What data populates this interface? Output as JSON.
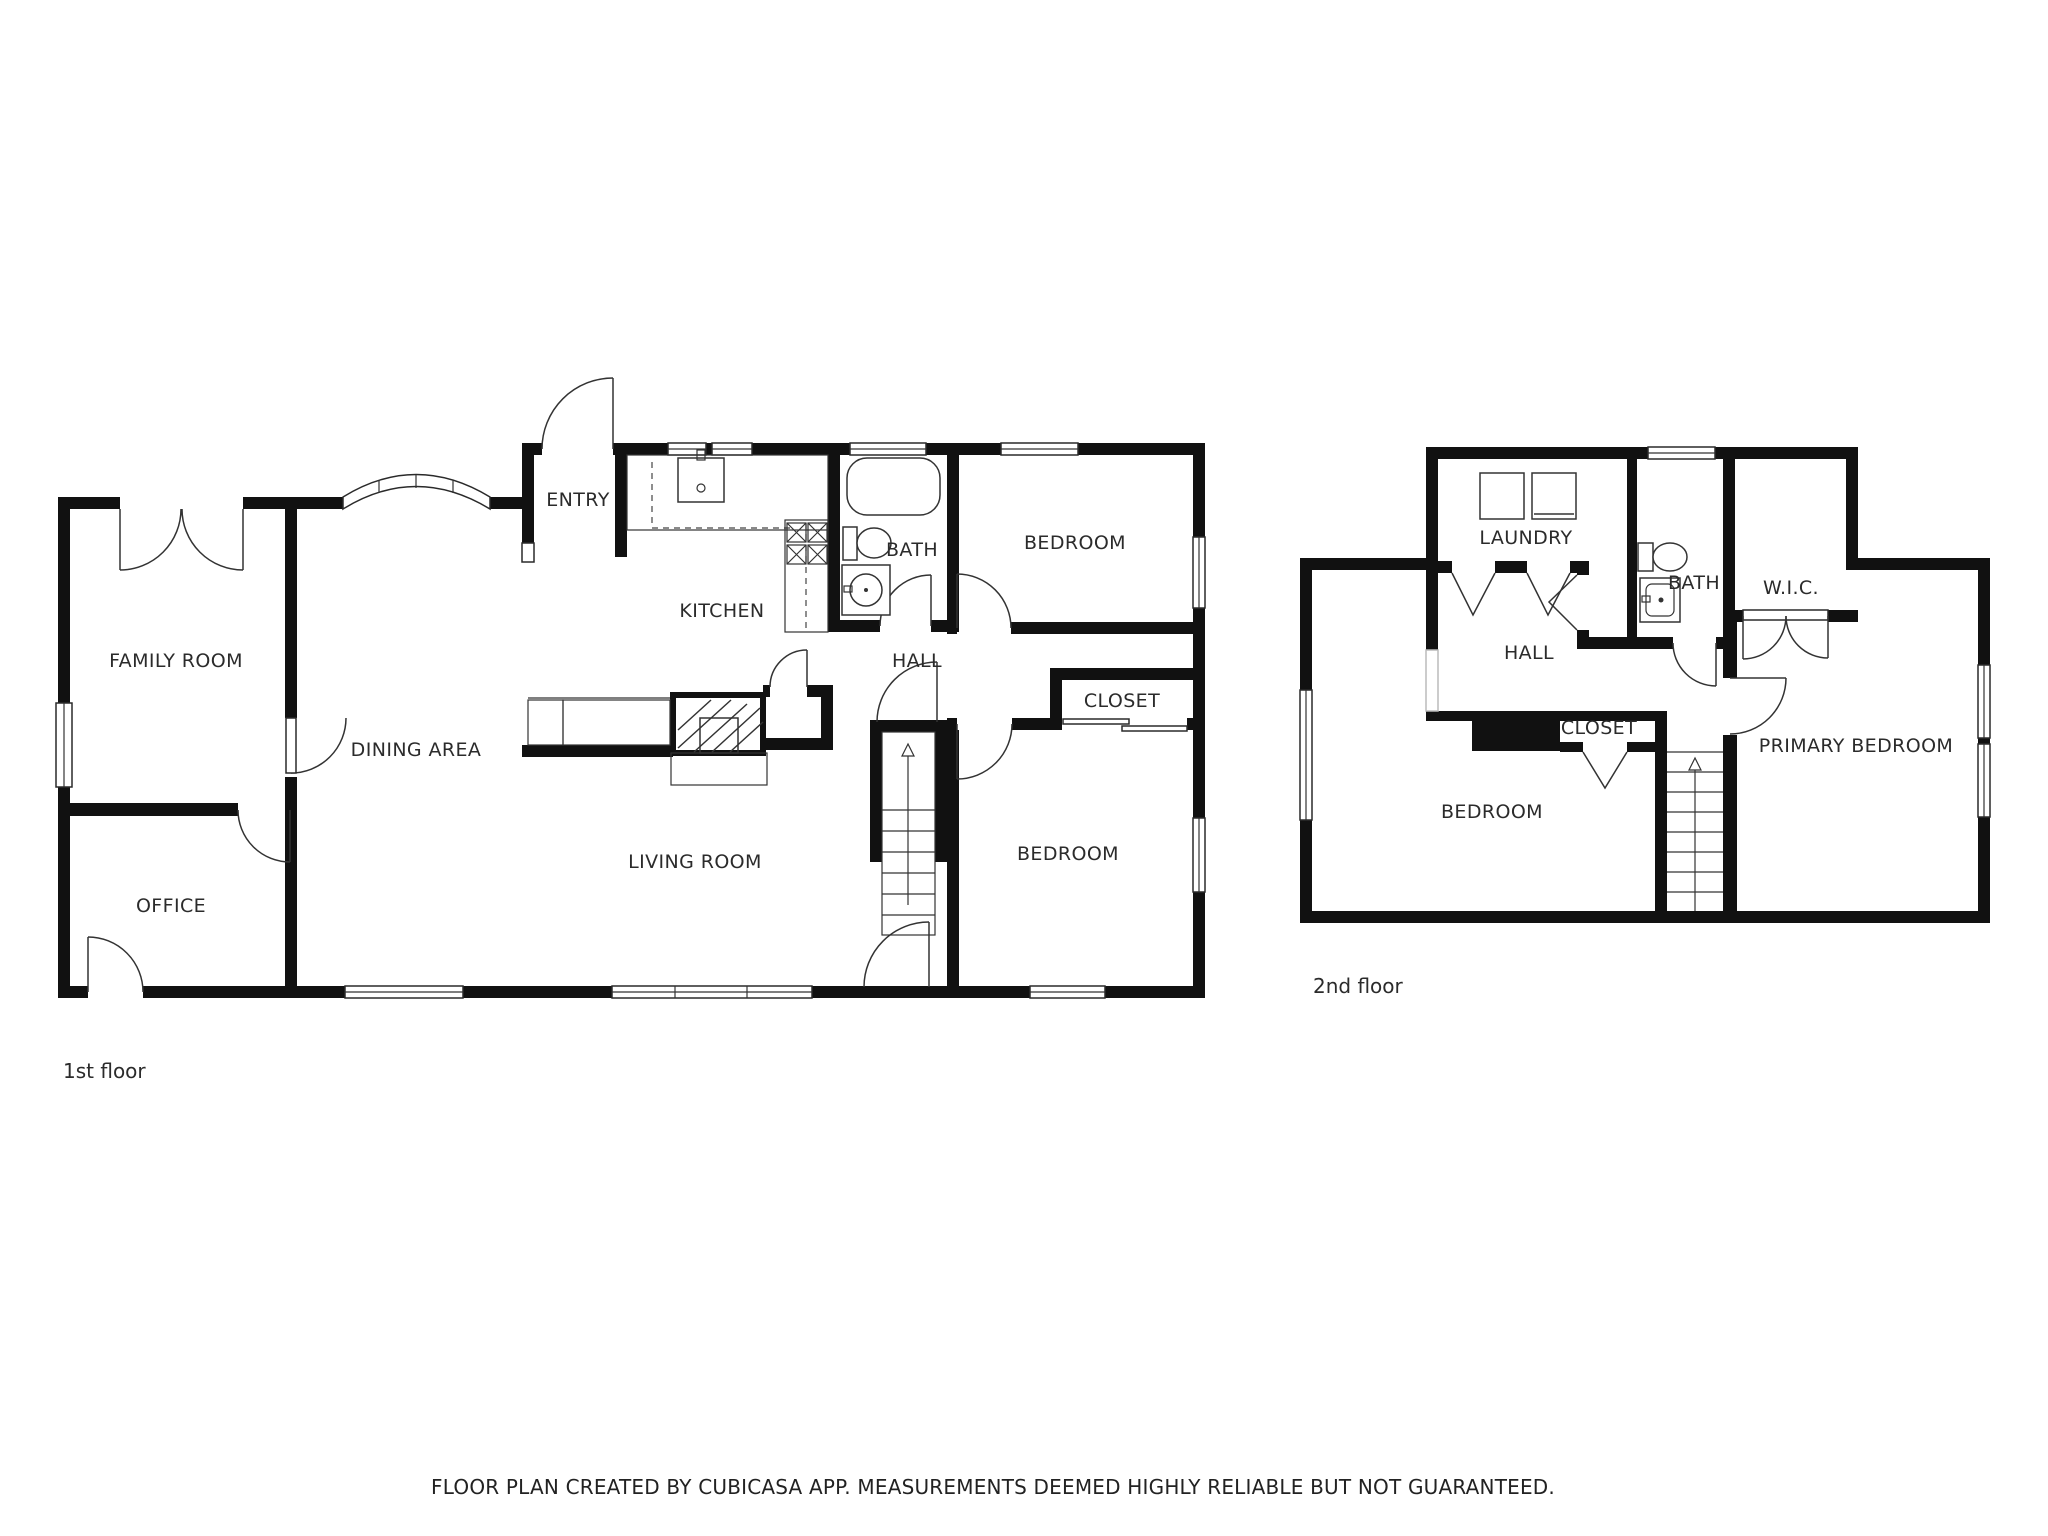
{
  "floors": [
    {
      "caption": "1st floor",
      "rooms": [
        {
          "label": "ENTRY"
        },
        {
          "label": "KITCHEN"
        },
        {
          "label": "BATH"
        },
        {
          "label": "BEDROOM"
        },
        {
          "label": "HALL"
        },
        {
          "label": "CLOSET"
        },
        {
          "label": "FAMILY ROOM"
        },
        {
          "label": "DINING AREA"
        },
        {
          "label": "LIVING ROOM"
        },
        {
          "label": "OFFICE"
        },
        {
          "label": "BEDROOM"
        }
      ],
      "fixtures": [
        "entry-door",
        "french-doors",
        "bay-window",
        "kitchen-sink",
        "stove-burners",
        "bathtub",
        "toilet",
        "bathroom-sink",
        "fireplace",
        "staircase-up",
        "sliding-closet-door"
      ]
    },
    {
      "caption": "2nd floor",
      "rooms": [
        {
          "label": "LAUNDRY"
        },
        {
          "label": "BATH"
        },
        {
          "label": "W.I.C."
        },
        {
          "label": "HALL"
        },
        {
          "label": "CLOSET"
        },
        {
          "label": "PRIMARY BEDROOM"
        },
        {
          "label": "BEDROOM"
        }
      ],
      "fixtures": [
        "washer",
        "dryer",
        "toilet",
        "bathroom-sink",
        "staircase-up",
        "bifold-doors",
        "double-closet-doors"
      ]
    }
  ],
  "footer": {
    "disclaimer": "FLOOR PLAN CREATED BY CUBICASA APP. MEASUREMENTS DEEMED HIGHLY RELIABLE BUT NOT GUARANTEED."
  },
  "colors": {
    "wall": "#111111",
    "line": "#333333",
    "background": "#ffffff"
  }
}
